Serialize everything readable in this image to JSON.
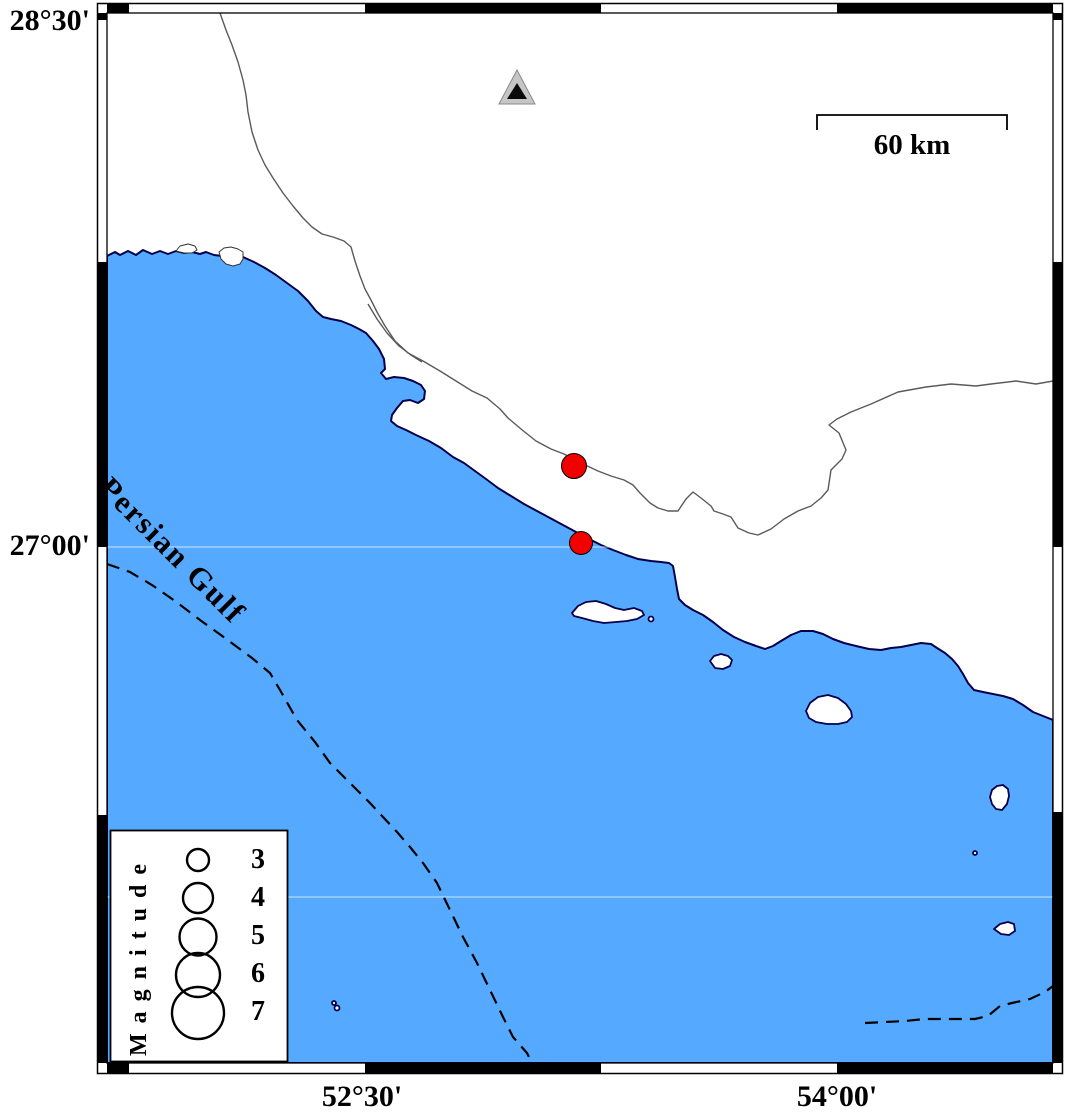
{
  "frame": {
    "lat_labels": [
      {
        "text": "28°30'"
      },
      {
        "text": "27°00'"
      }
    ],
    "lon_labels": [
      {
        "text": "52°30'"
      },
      {
        "text": "54°00'"
      }
    ]
  },
  "map": {
    "sea_label": "Persian Gulf",
    "scale_bar_label": "60 km",
    "station_symbol": "triangle",
    "earthquakes": [
      {
        "x": 574,
        "y": 466,
        "r": 12.5
      },
      {
        "x": 581,
        "y": 543,
        "r": 11.5
      }
    ]
  },
  "legend": {
    "title": "Magnitude",
    "circle_cx": 198,
    "items": [
      {
        "label": "3",
        "r": 11,
        "cy": 860
      },
      {
        "label": "4",
        "r": 15,
        "cy": 898
      },
      {
        "label": "5",
        "r": 18.5,
        "cy": 937
      },
      {
        "label": "6",
        "r": 22,
        "cy": 975
      },
      {
        "label": "7",
        "r": 26,
        "cy": 1013
      }
    ]
  },
  "colors": {
    "sea": "#55aaff",
    "coast": "#00004d",
    "land": "#ffffff",
    "earthquake": "#f20000",
    "boundary_gray": "#5a5a5a",
    "station_gray": "#c6c6c6",
    "frame_black": "#000000"
  }
}
